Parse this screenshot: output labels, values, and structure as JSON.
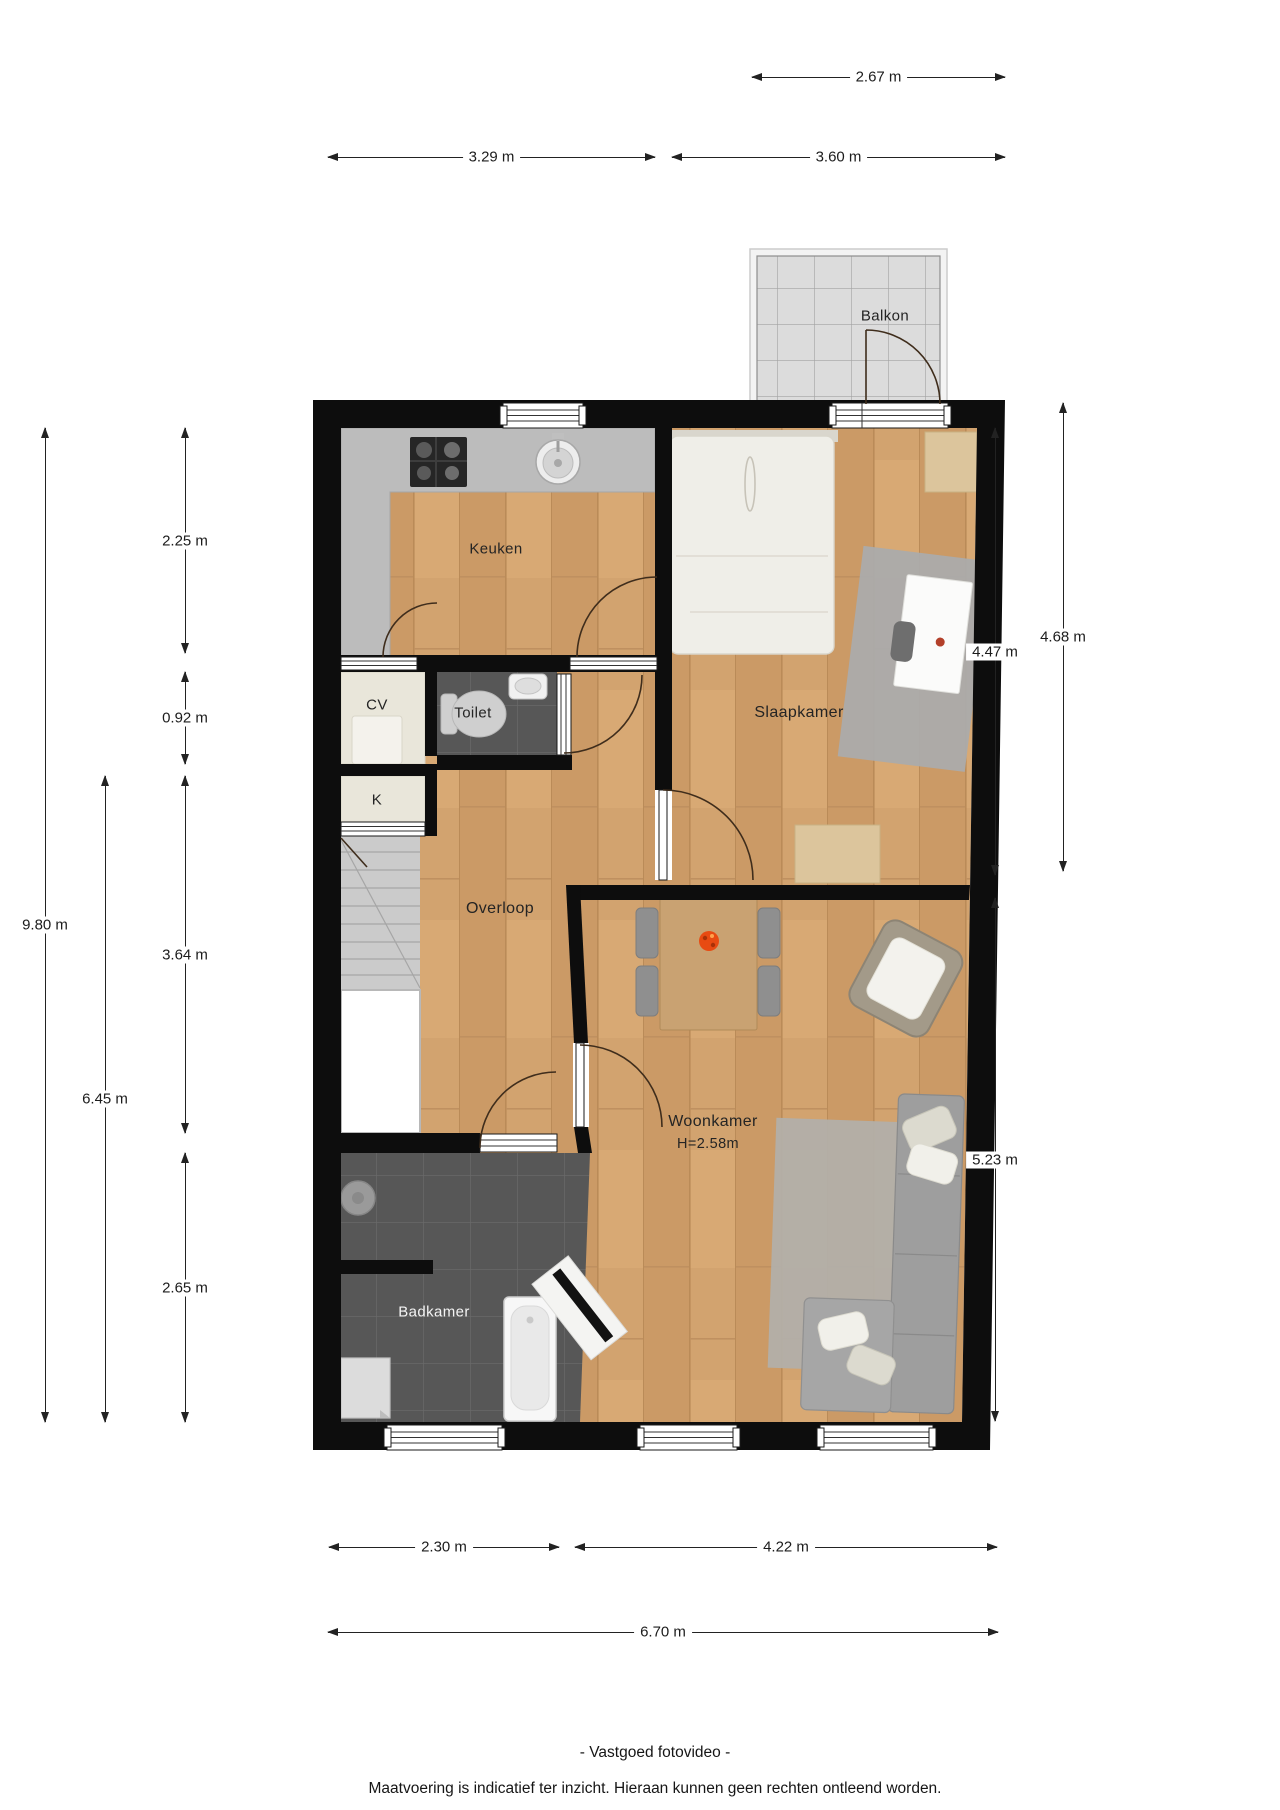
{
  "plan": {
    "balcony_label": "Balkon",
    "room_labels": {
      "keuken": "Keuken",
      "cv": "CV",
      "toilet": "Toilet",
      "k": "K",
      "slaapkamer": "Slaapkamer",
      "overloop": "Overloop",
      "woonkamer": "Woonkamer",
      "woonkamer_height": "H=2.58m",
      "badkamer": "Badkamer"
    },
    "colors": {
      "wall": "#0d0d0d",
      "wood_floor": "#d2a36f",
      "dark_tile": "#575757",
      "kitchen_counter": "#bcbcbc",
      "closet_beige": "#e9e6da",
      "balcony_tile": "#dcdcdc",
      "flower_accent": "#e84b12"
    }
  },
  "dims": {
    "top": [
      {
        "label": "2.67 m"
      },
      {
        "label": "3.29 m"
      },
      {
        "label": "3.60 m"
      }
    ],
    "left": [
      {
        "label": "9.80 m"
      },
      {
        "label": "6.45 m"
      },
      {
        "label": "2.25 m"
      },
      {
        "label": "0.92 m"
      },
      {
        "label": "3.64 m"
      },
      {
        "label": "2.65 m"
      }
    ],
    "right": [
      {
        "label": "4.47 m"
      },
      {
        "label": "4.68 m"
      },
      {
        "label": "5.23 m"
      }
    ],
    "bottom": [
      {
        "label": "2.30 m"
      },
      {
        "label": "4.22 m"
      },
      {
        "label": "6.70 m"
      }
    ]
  },
  "footer": {
    "line1": "- Vastgoed fotovideo -",
    "line2": "Maatvoering is indicatief ter inzicht. Hieraan kunnen geen rechten ontleend worden."
  }
}
